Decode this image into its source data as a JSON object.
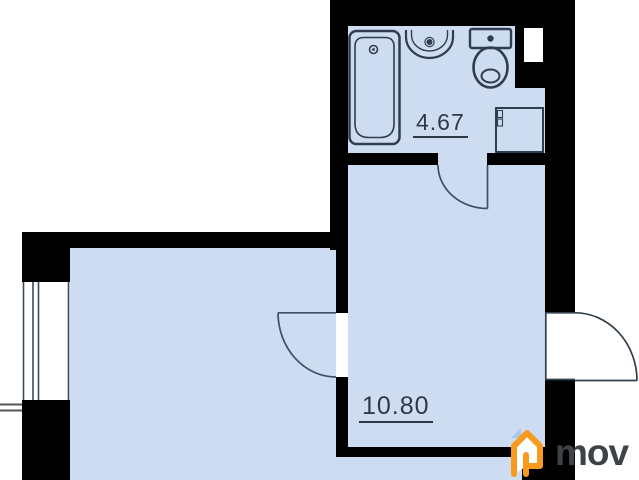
{
  "title": "apartment-floor-plan",
  "rooms": [
    {
      "name": "bathroom",
      "area": "4.67"
    },
    {
      "name": "living-room",
      "area": "10.80"
    }
  ],
  "fixtures": [
    "bathtub",
    "sink",
    "toilet",
    "cabinet"
  ],
  "doors": [
    "bathroom-door",
    "interior-door",
    "entrance-door"
  ],
  "features": [
    "window",
    "balcony-divider-lines",
    "wall-niche"
  ],
  "logo": {
    "text": "mov",
    "icon": "house-icon"
  },
  "theme": {
    "wall": "#000000",
    "room": "#cedcf2",
    "stroke": "#2f3e4e",
    "door": "#3f4f63",
    "label": "#2c3a48",
    "accent": "#f79a1e",
    "accent-blue": "#a9c9ea",
    "logo-text": "#3e4347"
  }
}
